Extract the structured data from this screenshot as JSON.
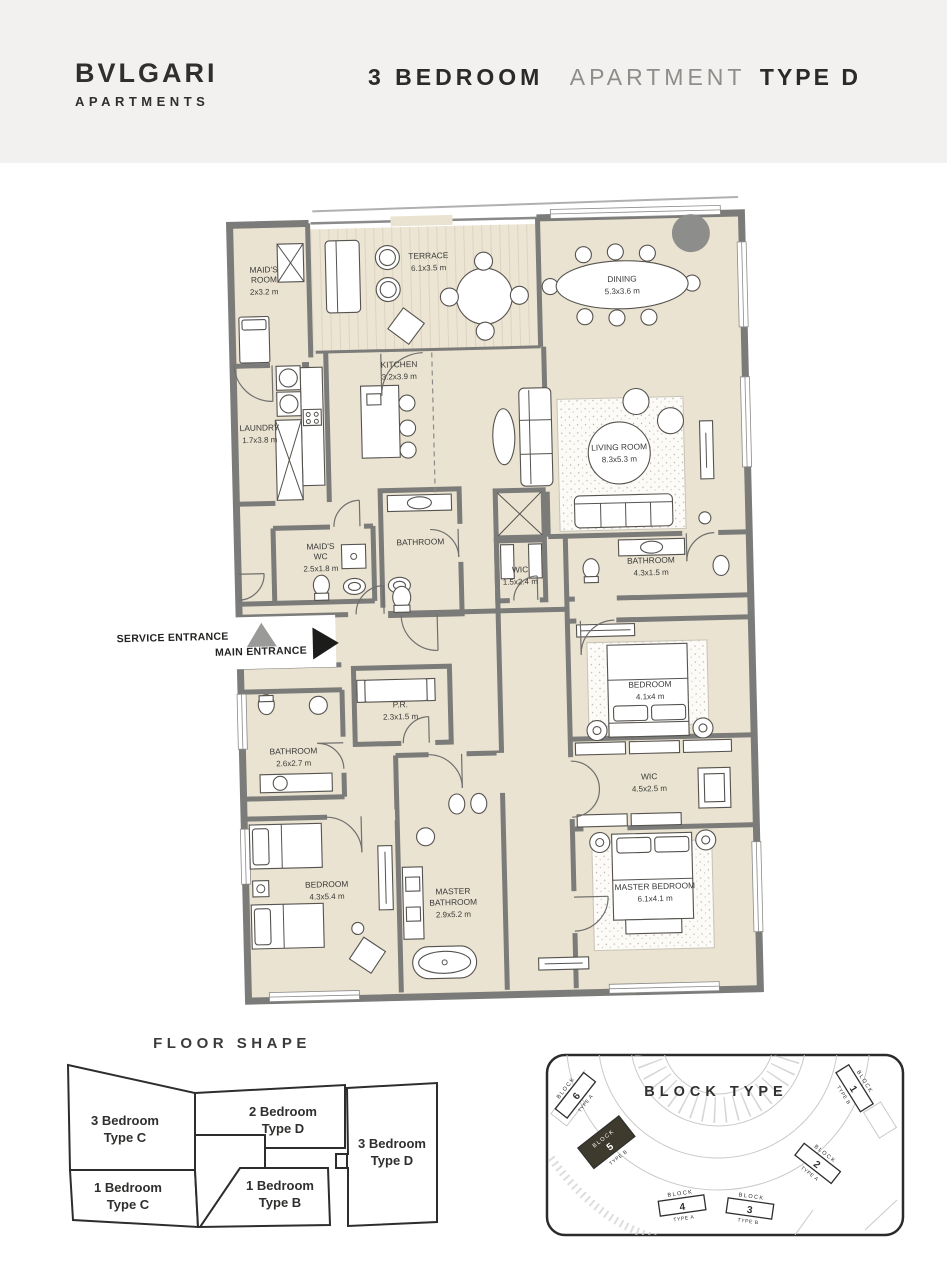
{
  "header": {
    "brand_line1": "BVLGARI",
    "brand_line2": "APARTMENTS",
    "title_bold": "3 BEDROOM",
    "title_light": "APARTMENT",
    "title_suffix": "TYPE D"
  },
  "floor_plan": {
    "rooms": [
      {
        "id": "maids-room",
        "lines": [
          "MAID'S",
          "ROOM",
          "2x3.2 m"
        ]
      },
      {
        "id": "terrace",
        "lines": [
          "TERRACE",
          "6.1x3.5 m"
        ]
      },
      {
        "id": "dining",
        "lines": [
          "DINING",
          "5.3x3.6 m"
        ]
      },
      {
        "id": "kitchen",
        "lines": [
          "KITCHEN",
          "3.2x3.9 m"
        ]
      },
      {
        "id": "laundry",
        "lines": [
          "LAUNDRY",
          "1.7x3.8 m"
        ]
      },
      {
        "id": "living-room",
        "lines": [
          "LIVING ROOM",
          "8.3x5.3 m"
        ]
      },
      {
        "id": "maids-wc",
        "lines": [
          "MAID'S",
          "WC",
          "2.5x1.8 m"
        ]
      },
      {
        "id": "bathroom-guest",
        "lines": [
          "BATHROOM"
        ]
      },
      {
        "id": "wic-bedroom",
        "lines": [
          "WIC",
          "1.5x2.4 m"
        ]
      },
      {
        "id": "bathroom-bedroom",
        "lines": [
          "BATHROOM",
          "4.3x1.5 m"
        ]
      },
      {
        "id": "powder-room",
        "lines": [
          "P.R.",
          "2.3x1.5 m"
        ]
      },
      {
        "id": "bathroom-2",
        "lines": [
          "BATHROOM",
          "2.6x2.7 m"
        ]
      },
      {
        "id": "bedroom-2",
        "lines": [
          "BEDROOM",
          "4.1x4 m"
        ]
      },
      {
        "id": "wic-master",
        "lines": [
          "WIC",
          "4.5x2.5 m"
        ]
      },
      {
        "id": "bedroom-3",
        "lines": [
          "BEDROOM",
          "4.3x5.4 m"
        ]
      },
      {
        "id": "master-bathroom",
        "lines": [
          "MASTER",
          "BATHROOM",
          "2.9x5.2 m"
        ]
      },
      {
        "id": "master-bedroom",
        "lines": [
          "MASTER BEDROOM",
          "6.1x4.1 m"
        ]
      }
    ],
    "entrances": {
      "service": "SERVICE ENTRANCE",
      "main": "MAIN ENTRANCE"
    }
  },
  "floor_shape": {
    "title": "FLOOR SHAPE",
    "units": [
      {
        "line1": "3 Bedroom",
        "line2": "Type C",
        "highlighted": false
      },
      {
        "line1": "2 Bedroom",
        "line2": "Type D",
        "highlighted": false
      },
      {
        "line1": "3 Bedroom",
        "line2": "Type D",
        "highlighted": true
      },
      {
        "line1": "1 Bedroom",
        "line2": "Type C",
        "highlighted": false
      },
      {
        "line1": "1 Bedroom",
        "line2": "Type B",
        "highlighted": false
      }
    ]
  },
  "block_type": {
    "title": "BLOCK TYPE",
    "blocks": [
      {
        "word": "BLOCK",
        "number": "6",
        "type": "TYPE A",
        "highlighted": false
      },
      {
        "word": "BLOCK",
        "number": "5",
        "type": "TYPE B",
        "highlighted": true
      },
      {
        "word": "BLOCK",
        "number": "4",
        "type": "TYPE A",
        "highlighted": false
      },
      {
        "word": "BLOCK",
        "number": "3",
        "type": "TYPE B",
        "highlighted": false
      },
      {
        "word": "BLOCK",
        "number": "2",
        "type": "TYPE A",
        "highlighted": false
      },
      {
        "word": "BLOCK",
        "number": "1",
        "type": "TYPE B",
        "highlighted": false
      }
    ]
  },
  "colors": {
    "header_bg": "#f2f1ef",
    "floor": "#eae3d1",
    "wall": "#7b7b79",
    "highlight": "#9a937f",
    "block_highlight": "#3f3a2e",
    "accent_dark": "#1c1c1b",
    "text": "#3a3a39"
  }
}
